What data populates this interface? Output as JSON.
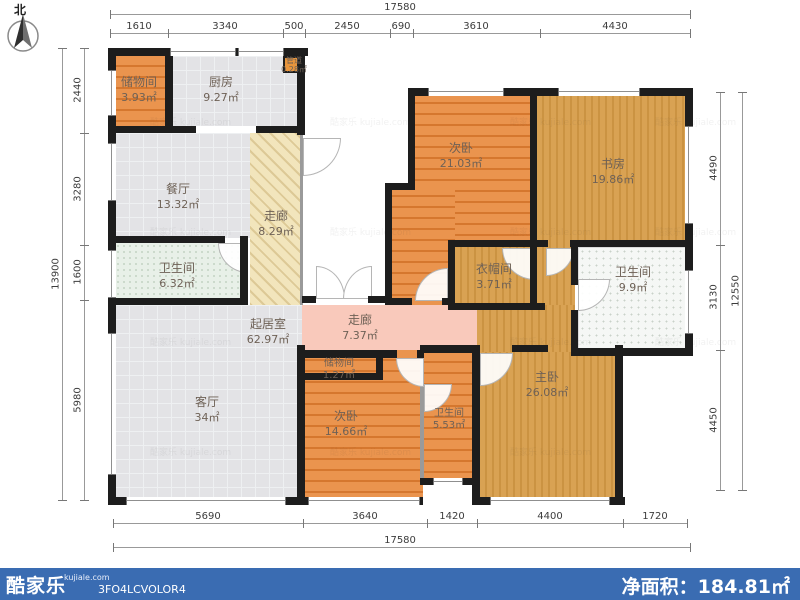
{
  "compass": {
    "label": "北"
  },
  "watermark": {
    "text": "酷家乐 kujiale.com"
  },
  "rooms": [
    {
      "name": "储物间",
      "area": "3.93㎡"
    },
    {
      "name": "厨房",
      "area": "9.27㎡"
    },
    {
      "name": "管道",
      "area": "0.28㎡"
    },
    {
      "name": "餐厅",
      "area": "13.32㎡"
    },
    {
      "name": "走廊",
      "area": "8.29㎡"
    },
    {
      "name": "卫生间",
      "area": "6.32㎡"
    },
    {
      "name": "起居室",
      "area": "62.97㎡"
    },
    {
      "name": "客厅",
      "area": "34㎡"
    },
    {
      "name": "走廊",
      "area": "7.37㎡"
    },
    {
      "name": "储物间",
      "area": "1.27㎡"
    },
    {
      "name": "次卧",
      "area": "14.66㎡"
    },
    {
      "name": "卫生间",
      "area": "5.53㎡"
    },
    {
      "name": "次卧",
      "area": "21.03㎡"
    },
    {
      "name": "书房",
      "area": "19.86㎡"
    },
    {
      "name": "衣帽间",
      "area": "3.71㎡"
    },
    {
      "name": "卫生间",
      "area": "9.9㎡"
    },
    {
      "name": "主卧",
      "area": "26.08㎡"
    }
  ],
  "dims": {
    "top": {
      "total": "17580",
      "segments": [
        "1610",
        "3340",
        "500",
        "2450",
        "690",
        "3610",
        "4430"
      ]
    },
    "bottom": {
      "total": "17580",
      "segments": [
        "5690",
        "3640",
        "1420",
        "4400",
        "1720"
      ]
    },
    "left": {
      "total": "13900",
      "segments": [
        "2440",
        "3280",
        "1600",
        "5980"
      ]
    },
    "right": {
      "total": "12550",
      "segments": [
        "4490",
        "3130",
        "4450"
      ]
    }
  },
  "footer": {
    "brand": "酷家乐",
    "domain": "kujiale.com",
    "code": "3FO4LCVOLOR4",
    "net_area_label": "净面积：",
    "net_area_value": "184.81㎡",
    "bar_color": "#3a6cb2"
  },
  "colors": {
    "wall": "#1d1d1d",
    "tile_gray": "#e3e3e6",
    "wood_orange": "#e1823c",
    "wood_gold": "#d9a253",
    "corridor_yellow": "#f2e5bc",
    "corridor_pink": "#f9c9bb",
    "bath_mint": "#e8f0e8",
    "footer_blue": "#3a6cb2"
  }
}
